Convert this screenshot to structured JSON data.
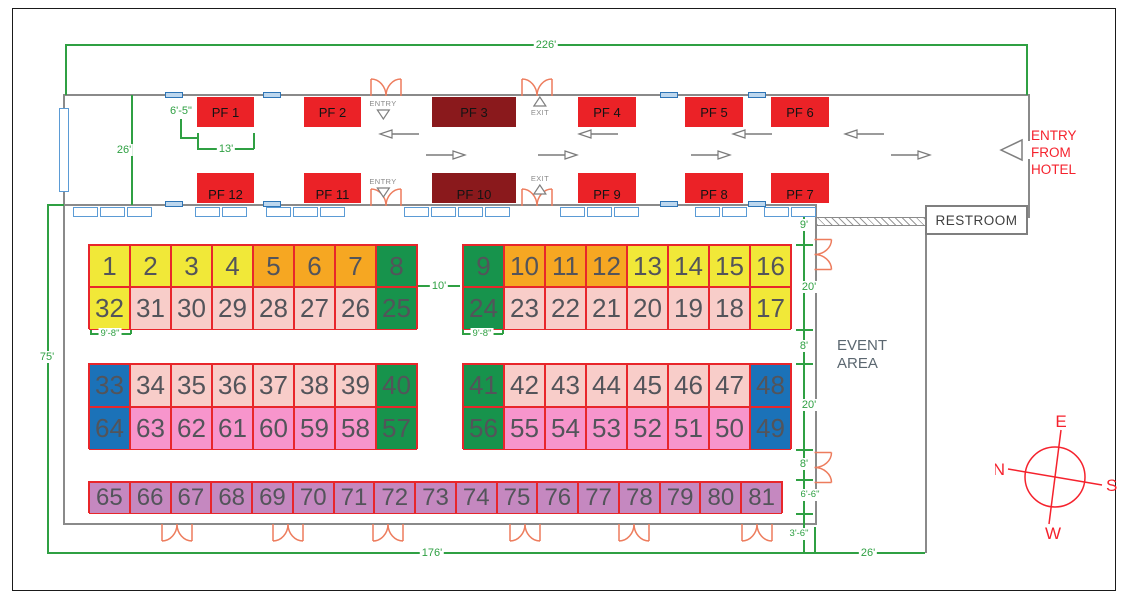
{
  "dimensions": {
    "hall_width_top": "226'",
    "corridor_depth": "26'",
    "hall_height_left": "75'",
    "hall_width_bottom": "176'",
    "bottom_right_width": "26'",
    "aisle_width": "10'",
    "booth_width_left": "9'-8\"",
    "booth_width_right": "9'-8\"",
    "pf1_depth": "6'-5\"",
    "pf1_width": "13'",
    "right_gaps": [
      "9'",
      "20'",
      "8'",
      "20'",
      "8'",
      "6'-6\"",
      "3'-6\""
    ]
  },
  "pf_booths": {
    "top_row": [
      "PF 1",
      "PF 2",
      "PF 3",
      "PF 4",
      "PF 5",
      "PF 6"
    ],
    "bottom_row": [
      "PF 12",
      "PF 11",
      "PF 10",
      "PF 9",
      "PF 8",
      "PF 7"
    ]
  },
  "booth_blocks": [
    {
      "id": "upper-left",
      "rows": [
        [
          "1",
          "2",
          "3",
          "4",
          "5",
          "6",
          "7",
          "8"
        ],
        [
          "32",
          "31",
          "30",
          "29",
          "28",
          "27",
          "26",
          "25"
        ]
      ],
      "row_colors": [
        [
          "yellow",
          "yellow",
          "yellow",
          "yellow",
          "orange",
          "orange",
          "orange",
          "green"
        ],
        [
          "yellow",
          "blush",
          "blush",
          "blush",
          "blush",
          "blush",
          "blush",
          "green"
        ]
      ]
    },
    {
      "id": "upper-right",
      "rows": [
        [
          "9",
          "10",
          "11",
          "12",
          "13",
          "14",
          "15",
          "16"
        ],
        [
          "24",
          "23",
          "22",
          "21",
          "20",
          "19",
          "18",
          "17"
        ]
      ],
      "row_colors": [
        [
          "green",
          "orange",
          "orange",
          "orange",
          "yellow",
          "yellow",
          "yellow",
          "yellow"
        ],
        [
          "green",
          "blush",
          "blush",
          "blush",
          "blush",
          "blush",
          "blush",
          "yellow"
        ]
      ]
    },
    {
      "id": "middle-left",
      "rows": [
        [
          "33",
          "34",
          "35",
          "36",
          "37",
          "38",
          "39",
          "40"
        ],
        [
          "64",
          "63",
          "62",
          "61",
          "60",
          "59",
          "58",
          "57"
        ]
      ],
      "row_colors": [
        [
          "blue",
          "blush",
          "blush",
          "blush",
          "blush",
          "blush",
          "blush",
          "green"
        ],
        [
          "blue",
          "pink",
          "pink",
          "pink",
          "pink",
          "pink",
          "pink",
          "green"
        ]
      ]
    },
    {
      "id": "middle-right",
      "rows": [
        [
          "41",
          "42",
          "43",
          "44",
          "45",
          "46",
          "47",
          "48"
        ],
        [
          "56",
          "55",
          "54",
          "53",
          "52",
          "51",
          "50",
          "49"
        ]
      ],
      "row_colors": [
        [
          "green",
          "blush",
          "blush",
          "blush",
          "blush",
          "blush",
          "blush",
          "blue"
        ],
        [
          "green",
          "pink",
          "pink",
          "pink",
          "pink",
          "pink",
          "pink",
          "blue"
        ]
      ]
    },
    {
      "id": "bottom-strip",
      "rows": [
        [
          "65",
          "66",
          "67",
          "68",
          "69",
          "70",
          "71",
          "72",
          "73",
          "74",
          "75",
          "76",
          "77",
          "78",
          "79",
          "80",
          "81"
        ]
      ],
      "row_colors": [
        [
          "purple",
          "purple",
          "purple",
          "purple",
          "purple",
          "purple",
          "purple",
          "purple",
          "purple",
          "purple",
          "purple",
          "purple",
          "purple",
          "purple",
          "purple",
          "purple",
          "purple"
        ]
      ]
    }
  ],
  "colors": {
    "yellow": "#F1E838",
    "orange": "#F6A722",
    "green": "#17934C",
    "blush": "#F8CDC9",
    "pink": "#F795CC",
    "blue": "#1B72B8",
    "purple": "#C588C0",
    "pf_red": "#EB2227",
    "pf_dark_red": "#8A191C",
    "grid_red": "#E8262B",
    "dim_green": "#2FA043",
    "wall_gray": "#8A8A8A",
    "door_orange": "#ED7C5D",
    "opening_blue": "#BDD7EE",
    "accent_red_text": "#F5222D"
  },
  "labels": {
    "restroom": "RESTROOM",
    "event_area_line1": "EVENT",
    "event_area_line2": "AREA",
    "entry": "ENTRY",
    "exit": "EXIT",
    "entry_from_hotel_line1": "ENTRY",
    "entry_from_hotel_line2": "FROM",
    "entry_from_hotel_line3": "HOTEL"
  },
  "compass": {
    "north": "N",
    "east": "E",
    "south": "S",
    "west": "W"
  }
}
